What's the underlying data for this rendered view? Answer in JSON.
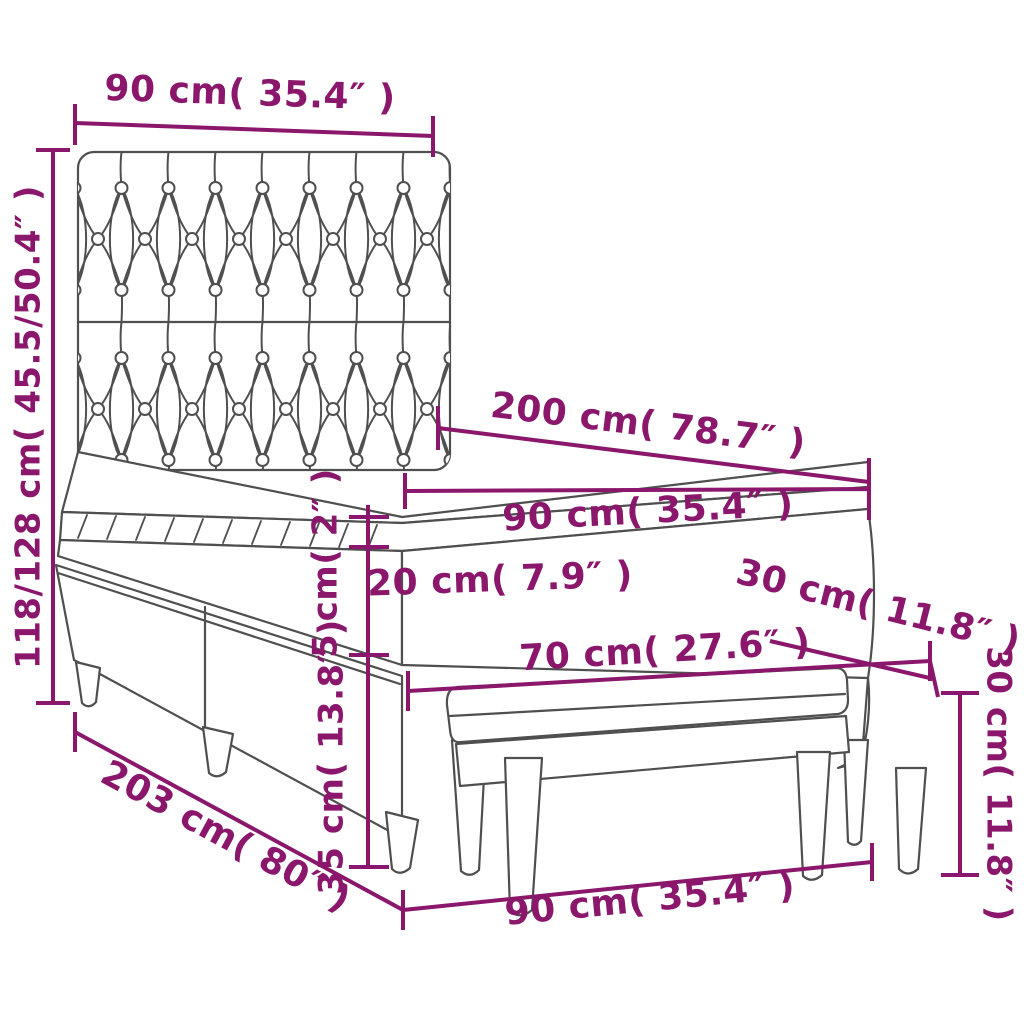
{
  "title": "Box spring bed with headboard and bench - dimensional diagram",
  "colors": {
    "dimension": "#8A176B",
    "line-art": "#4F4F4F",
    "background": "#FFFFFF"
  },
  "dimensions": {
    "headboard_width": "90 cm( 35.4″ )",
    "bed_height": "118/128 cm( 45.5/50.4″ )",
    "bed_length": "200 cm( 78.7″ )",
    "mattress_width": "90 cm( 35.4″ )",
    "topper_thickness": "5 cm( 2″ )",
    "mattress_thickness": "20 cm( 7.9″ )",
    "base_height": "35 cm( 13.8″ )",
    "bench_depth": "30 cm( 11.8″ )",
    "bench_length": "70 cm( 27.6″ )",
    "bench_height": "30 cm( 11.8″ )",
    "floor_length": "203 cm( 80″ )",
    "floor_width": "90 cm( 35.4″ )"
  }
}
